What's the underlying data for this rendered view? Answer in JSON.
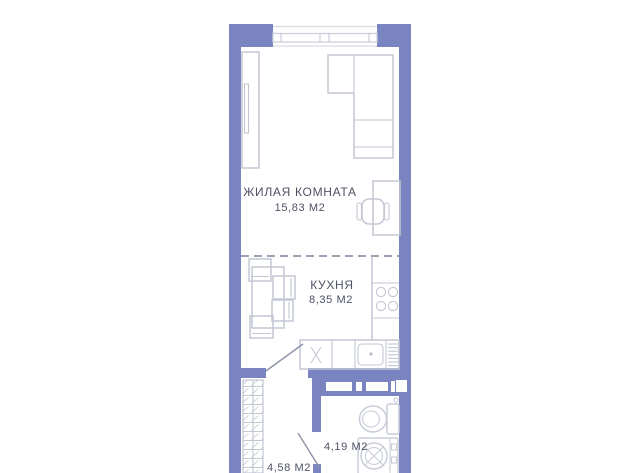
{
  "rooms": {
    "living": {
      "label": "ЖИЛАЯ КОМНАТА",
      "area": "15,83 М2"
    },
    "kitchen": {
      "label": "КУХНЯ",
      "area": "8,35 М2"
    },
    "bathroom": {
      "area": "4,19 М2"
    },
    "hallway": {
      "area": "4,58 М2"
    }
  },
  "colors": {
    "background": "#ffffff",
    "wall": "#7a84c1",
    "furniture": "#c3c6d4",
    "fixture": "#c9cdd9",
    "text": "#4d5264",
    "dash": "#9aa0b3",
    "door": "#8e93a7",
    "window_line": "#d9dbe4"
  }
}
